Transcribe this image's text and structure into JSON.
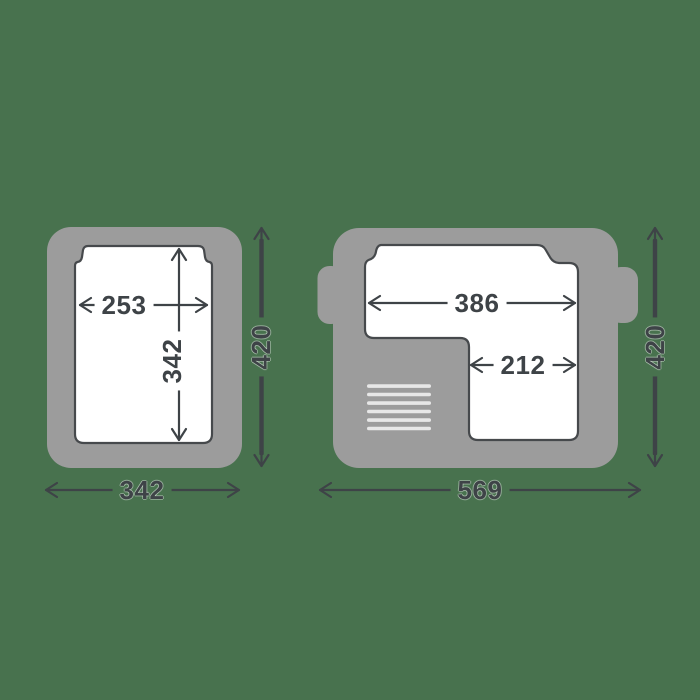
{
  "colors": {
    "background": "#48724e",
    "unit_body_gray": "#9c9c9c",
    "interior_white": "#ffffff",
    "line_and_text": "#3e4347",
    "outline": "#46494c",
    "vent_grille": "#e7e7e7"
  },
  "figures": {
    "left": {
      "labels": {
        "inner_width": "253",
        "inner_depth": "342",
        "outer_depth": "420",
        "outer_width": "342"
      }
    },
    "right": {
      "labels": {
        "main_compartment_width": "386",
        "lower_compartment_width": "212",
        "outer_depth": "420",
        "outer_width": "569"
      }
    }
  }
}
